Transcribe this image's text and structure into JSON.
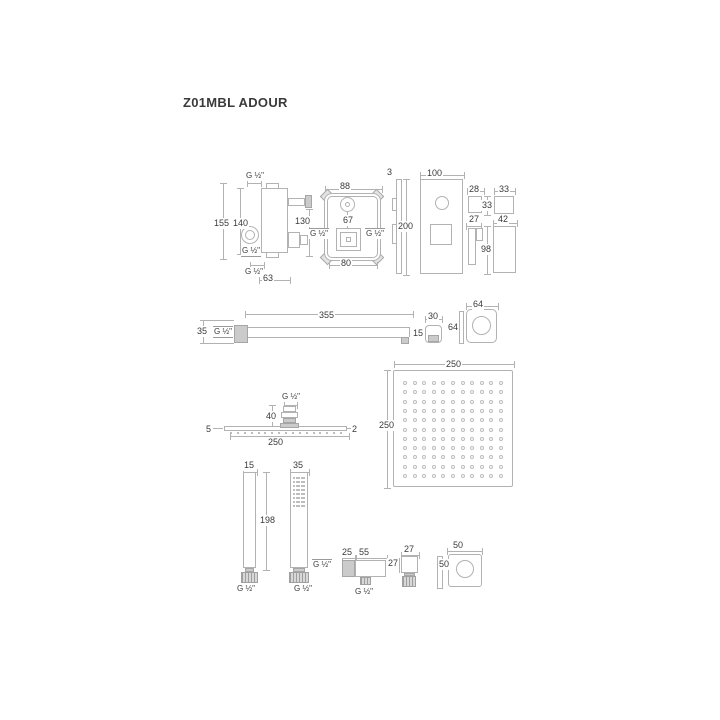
{
  "title": "Z01MBL ADOUR",
  "colors": {
    "line": "#b2b2b2",
    "fill": "#cbcbcb",
    "text": "#3a3a3a"
  },
  "figures": {
    "valve_side": {
      "g_top": "G ½\"",
      "d155": "155",
      "d140": "140",
      "d130": "130",
      "g_mid": "G ½\"",
      "g_bottom": "G ½\"",
      "d63": "63"
    },
    "valve_front": {
      "d88": "88",
      "d67": "67",
      "g_left": "G ½\"",
      "g_right": "G ½\"",
      "d80": "80"
    },
    "plate": {
      "d3": "3",
      "d200": "200",
      "d100": "100"
    },
    "trim_parts": {
      "d28": "28",
      "d33_w": "33",
      "d33_h": "33",
      "d27": "27",
      "d42": "42",
      "d98": "98"
    },
    "arm": {
      "d355": "355",
      "d35": "35",
      "g": "G ½\"",
      "d30": "30",
      "d15": "15",
      "d64_w": "64",
      "d64_h": "64"
    },
    "head_side": {
      "g": "G ½\"",
      "d40": "40",
      "d5": "5",
      "d2": "2",
      "d250": "250"
    },
    "head_top": {
      "d250_w": "250",
      "d250_h": "250"
    },
    "hand_shower": {
      "d15": "15",
      "d198": "198",
      "g_left": "G ½\"",
      "d35": "35",
      "g_right": "G ½\""
    },
    "elbow": {
      "d25": "25",
      "d55": "55",
      "g_in": "G ½\"",
      "g_out": "G ½\"",
      "d27_w": "27",
      "d27_h": "27"
    },
    "outlet_flange": {
      "d50_w": "50",
      "d50_h": "50"
    }
  },
  "grids": {
    "head_top": {
      "rows": 11,
      "cols": 11,
      "dot": 4,
      "filled": false
    },
    "head_nozzles": {
      "rows": 1,
      "cols": 17,
      "dot": 2,
      "filled": true
    },
    "hand_face": {
      "rows": 8,
      "cols": 5,
      "dot": 2,
      "filled": true
    }
  }
}
